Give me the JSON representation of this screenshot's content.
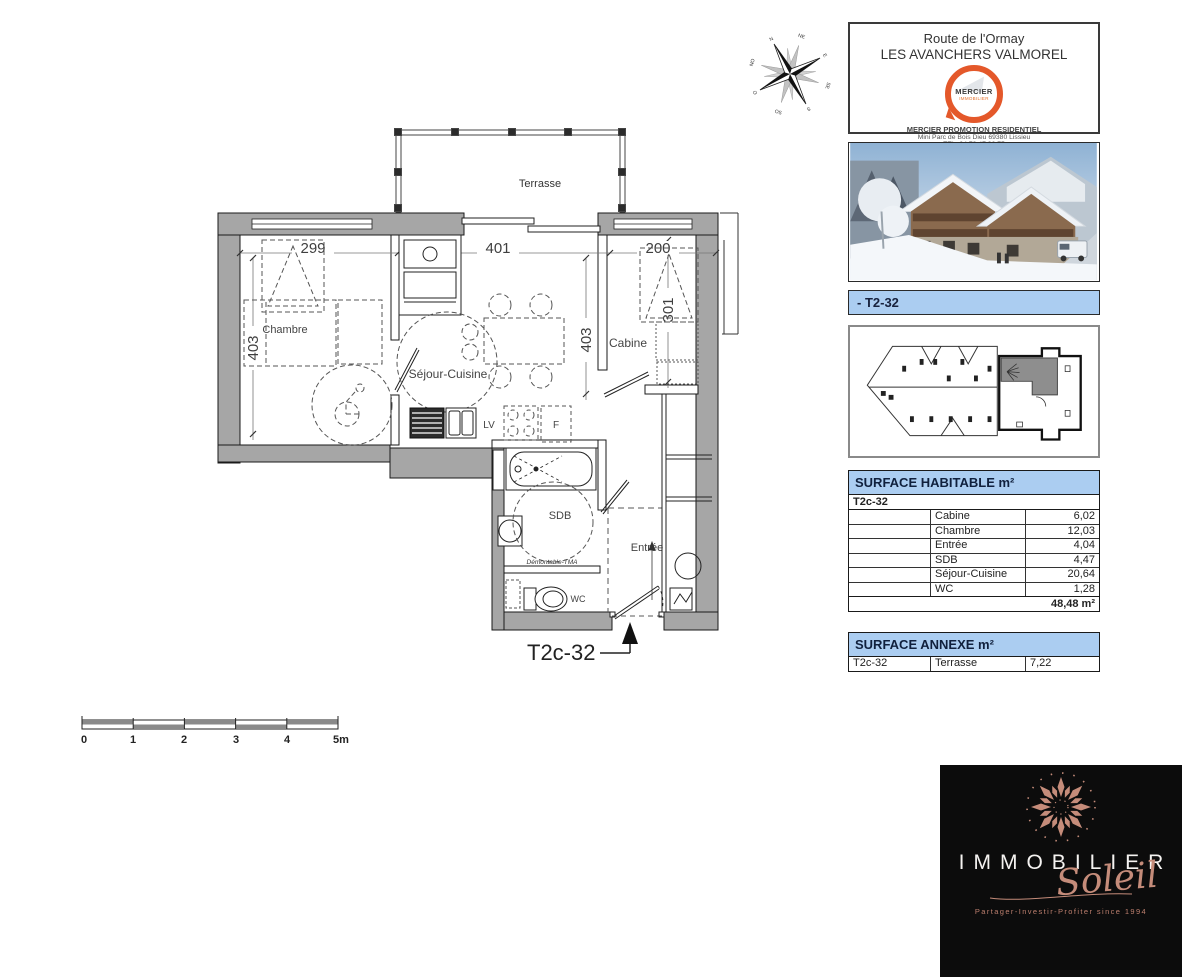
{
  "colors": {
    "accent_blue": "#abcdf1",
    "wall_gray": "#a6a6a6",
    "mercier_orange": "#e4582a",
    "brand_black": "#0c0c0c",
    "brand_rose": "#c58c7a",
    "siteplan_highlight": "#8e8e8e"
  },
  "agency": {
    "line1": "Route de l'Ormay",
    "line2": "LES AVANCHERS VALMOREL",
    "logo_name": "MERCIER",
    "logo_sub": "IMMOBILIER",
    "line3": "MERCIER PROMOTION RESIDENTIEL",
    "line4": "Mini Parc de Bois Dieu 69380 Lissieu",
    "line5": "TEL. 04 78 47 36 75"
  },
  "unit_bar": {
    "label": "- T2-32"
  },
  "plan": {
    "callout": "T2c-32",
    "rooms": {
      "terrasse": "Terrasse",
      "chambre": "Chambre",
      "sejour": "Séjour-Cuisine",
      "cabine": "Cabine",
      "sdb": "SDB",
      "wc": "WC",
      "entree": "Entrée"
    },
    "appliances": {
      "dishwasher": "LV",
      "fridge": "F"
    },
    "note_demontable": "Démontable-TMA",
    "dims": {
      "chambre_w": "299",
      "sejour_w": "401",
      "cabine_w": "200",
      "chambre_h": "403",
      "sejour_h": "403",
      "cabine_h": "301"
    },
    "compass": [
      "N",
      "NE",
      "E",
      "SE",
      "S",
      "SO",
      "O",
      "NO"
    ],
    "scale_bar": {
      "t0": "0",
      "t1": "1",
      "t2": "2",
      "t3": "3",
      "t4": "4",
      "t5": "5m"
    }
  },
  "surface_habitable": {
    "title": "SURFACE HABITABLE m²",
    "unit": "T2c-32",
    "rows": [
      [
        "Cabine",
        "6,02"
      ],
      [
        "Chambre",
        "12,03"
      ],
      [
        "Entrée",
        "4,04"
      ],
      [
        "SDB",
        "4,47"
      ],
      [
        "Séjour-Cuisine",
        "20,64"
      ],
      [
        "WC",
        "1,28"
      ]
    ],
    "total": "48,48 m²"
  },
  "surface_annexe": {
    "title": "SURFACE ANNEXE m²",
    "row": {
      "unit": "T2c-32",
      "room": "Terrasse",
      "value": "7,22"
    }
  },
  "brand": {
    "word": "IMMOBILIER",
    "script": "Soleil",
    "tagline": "Partager-Investir-Profiter since 1994"
  }
}
